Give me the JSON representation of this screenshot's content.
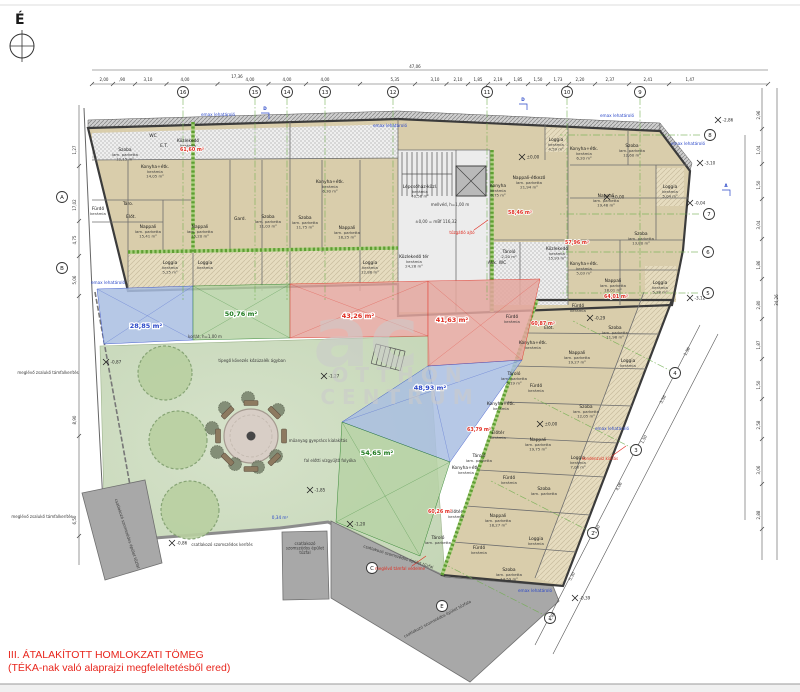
{
  "title_block": {
    "line1": "III. ÁTALAKÍTOTT HOMLOKZATI TÖMEG",
    "line2": "(TÉKA-nak való alaprajzi megfeleltetésből ered)"
  },
  "north": {
    "label": "É"
  },
  "watermark": {
    "monogram": "ac",
    "line1": "OTTHON",
    "line2": "CENTRUM"
  },
  "colors": {
    "room_fill": "#d9cdab",
    "loggia_fill": "#e3d9bd",
    "corridor_fill": "#ededed",
    "garden": "#cddcc1",
    "neighbor_gray": "#a8a8a8",
    "wall": "#3b3b3b",
    "green_wall": "#5f9e33",
    "grid_green": "#6fae4e",
    "zone_blue": "#aabfe2",
    "zone_green": "#b8d3a6",
    "zone_red": "#e4a79f",
    "text_blue": "#2b48c8",
    "text_green": "#1e7a1e",
    "text_red": "#e02c20"
  },
  "grid_bubbles": {
    "top": [
      {
        "l": "16",
        "x": 183
      },
      {
        "l": "15",
        "x": 255
      },
      {
        "l": "14",
        "x": 287
      },
      {
        "l": "13",
        "x": 325
      },
      {
        "l": "12",
        "x": 393
      },
      {
        "l": "11",
        "x": 487
      },
      {
        "l": "10",
        "x": 567
      },
      {
        "l": "9",
        "x": 640
      }
    ],
    "right": [
      {
        "l": "8",
        "x": 710,
        "y": 135
      },
      {
        "l": "7",
        "x": 709,
        "y": 214
      },
      {
        "l": "6",
        "x": 708,
        "y": 252
      },
      {
        "l": "5",
        "x": 708,
        "y": 293
      }
    ],
    "diag": [
      {
        "l": "4",
        "x": 675,
        "y": 373
      },
      {
        "l": "3",
        "x": 636,
        "y": 450
      },
      {
        "l": "2",
        "x": 593,
        "y": 533
      },
      {
        "l": "1",
        "x": 550,
        "y": 618
      }
    ],
    "letters": [
      {
        "l": "A",
        "x": 62,
        "y": 197
      },
      {
        "l": "B",
        "x": 62,
        "y": 268
      },
      {
        "l": "C",
        "x": 372,
        "y": 568
      },
      {
        "l": "E",
        "x": 442,
        "y": 606
      }
    ]
  },
  "dimensions": {
    "total_top": {
      "t": "47,06",
      "x": 415,
      "y": 68
    },
    "mid_top": {
      "t": "17,36",
      "x": 237,
      "y": 78
    },
    "top_row": [
      {
        "t": "2,00",
        "x": 104
      },
      {
        "t": ",90",
        "x": 122
      },
      {
        "t": "3,10",
        "x": 148
      },
      {
        "t": "4,00",
        "x": 185
      },
      {
        "t": "4,00",
        "x": 250
      },
      {
        "t": "4,00",
        "x": 287
      },
      {
        "t": "4,00",
        "x": 325
      },
      {
        "t": "5,35",
        "x": 395
      },
      {
        "t": "3,10",
        "x": 435
      },
      {
        "t": "2,10",
        "x": 458
      },
      {
        "t": "1,85",
        "x": 478
      },
      {
        "t": "2,19",
        "x": 498
      },
      {
        "t": "1,85",
        "x": 518
      },
      {
        "t": "1,50",
        "x": 538
      },
      {
        "t": "1,73",
        "x": 558
      },
      {
        "t": "2,20",
        "x": 580
      },
      {
        "t": "2,37",
        "x": 610
      },
      {
        "t": "2,41",
        "x": 648
      },
      {
        "t": "1,47",
        "x": 690
      }
    ],
    "left_col": [
      {
        "t": "1,27",
        "y": 150
      },
      {
        "t": "17,02",
        "y": 205
      },
      {
        "t": "4,75",
        "y": 240
      },
      {
        "t": "5,06",
        "y": 280
      },
      {
        "t": "8,90",
        "y": 420
      },
      {
        "t": "6,50",
        "y": 520
      }
    ],
    "right_col": [
      {
        "t": "2,96",
        "y": 115
      },
      {
        "t": "1,04",
        "y": 150
      },
      {
        "t": "1,50",
        "y": 185
      },
      {
        "t": "3,04",
        "y": 225
      },
      {
        "t": "1,86",
        "y": 265
      },
      {
        "t": "2,80",
        "y": 305
      },
      {
        "t": "1,87",
        "y": 345
      },
      {
        "t": "1,50",
        "y": 385
      },
      {
        "t": "2,58",
        "y": 425
      },
      {
        "t": "3,06",
        "y": 470
      },
      {
        "t": "2,88",
        "y": 515
      }
    ],
    "right_total": {
      "t": "34,26",
      "x": 778,
      "y": 300
    },
    "diag_chain": [
      {
        "t": "1,36",
        "x": 688,
        "y": 352
      },
      {
        "t": "3,56",
        "x": 664,
        "y": 400
      },
      {
        "t": "1,50",
        "x": 645,
        "y": 440
      },
      {
        "t": "4,06",
        "x": 620,
        "y": 487
      },
      {
        "t": "1,50",
        "x": 598,
        "y": 530
      },
      {
        "t": "5,30",
        "x": 573,
        "y": 577
      },
      {
        "t": "2,88",
        "x": 553,
        "y": 617
      }
    ]
  },
  "zones": [
    {
      "label": "28,85 m²",
      "c": "#aabfe2",
      "t": "#2b48c8",
      "pts": "97,289 193,286 193,340 104,344",
      "lx": 146,
      "ly": 328
    },
    {
      "label": "50,76 m²",
      "c": "#b8d3a6",
      "t": "#1e7a1e",
      "pts": "193,286 290,284 290,338 193,340",
      "lx": 241,
      "ly": 316
    },
    {
      "label": "43,26 m²",
      "c": "#e4a79f",
      "t": "#e02c20",
      "pts": "290,284 428,281 428,336 290,338",
      "lx": 358,
      "ly": 318
    },
    {
      "label": "41,63 m²",
      "c": "#e4a79f",
      "t": "#e02c20",
      "pts": "428,281 540,279 522,360 428,366",
      "lx": 452,
      "ly": 322
    },
    {
      "label": "48,93 m²",
      "c": "#aabfe2",
      "t": "#2b48c8",
      "pts": "428,366 522,360 450,462 342,422",
      "lx": 430,
      "ly": 390
    },
    {
      "label": "54,65 m²",
      "c": "#b8d3a6",
      "t": "#1e7a1e",
      "pts": "342,422 450,462 420,556 336,522",
      "lx": 377,
      "ly": 455
    }
  ],
  "rooms": [
    {
      "x": 125,
      "y": 151,
      "lines": [
        "Szoba",
        "lam. parketta",
        "12,15 m²"
      ]
    },
    {
      "x": 155,
      "y": 168,
      "lines": [
        "Konyha+étk.",
        "kerámia",
        "14,05 m²"
      ]
    },
    {
      "x": 98,
      "y": 210,
      "lines": [
        "Fürdő",
        "kerámia"
      ]
    },
    {
      "x": 128,
      "y": 205,
      "lines": [
        "Táro."
      ]
    },
    {
      "x": 131,
      "y": 218,
      "lines": [
        "Előt."
      ]
    },
    {
      "x": 148,
      "y": 228,
      "lines": [
        "Nappali",
        "lam. parketta",
        "15,41 m²"
      ]
    },
    {
      "x": 170,
      "y": 264,
      "lines": [
        "Loggia",
        "kerámia",
        "5,25 m²"
      ]
    },
    {
      "x": 200,
      "y": 228,
      "lines": [
        "Nappali",
        "lam. parketta",
        "15,20 m²"
      ]
    },
    {
      "x": 240,
      "y": 220,
      "lines": [
        "Gard."
      ]
    },
    {
      "x": 268,
      "y": 218,
      "lines": [
        "Szoba",
        "lam. parketta",
        "11,03 m²"
      ]
    },
    {
      "x": 205,
      "y": 264,
      "lines": [
        "Loggia",
        "kerámia"
      ]
    },
    {
      "x": 330,
      "y": 183,
      "lines": [
        "Konyha+étk.",
        "kerámia",
        "6,30 m²"
      ]
    },
    {
      "x": 305,
      "y": 219,
      "lines": [
        "Szoba",
        "lam. parketta",
        "11,75 m²"
      ]
    },
    {
      "x": 347,
      "y": 229,
      "lines": [
        "Nappali",
        "lam. parketta",
        "18,25 m²"
      ]
    },
    {
      "x": 370,
      "y": 264,
      "lines": [
        "Loggia",
        "kerámia",
        "12,86 m²"
      ]
    },
    {
      "x": 153,
      "y": 137,
      "lines": [
        "WC"
      ]
    },
    {
      "x": 164,
      "y": 147,
      "lines": [
        "E.T."
      ]
    },
    {
      "x": 188,
      "y": 142,
      "lines": [
        "Közlekedő",
        "kerámia"
      ]
    },
    {
      "x": 420,
      "y": 188,
      "lines": [
        "Lépcsőház-közl.",
        "kerámia",
        "40,56 m²"
      ]
    },
    {
      "x": 414,
      "y": 258,
      "lines": [
        "Közlekedő tér",
        "kerámia",
        "24,28 m²"
      ]
    },
    {
      "x": 498,
      "y": 187,
      "lines": [
        "Konyha",
        "kerámia",
        "6,75 m²"
      ]
    },
    {
      "x": 529,
      "y": 179,
      "lines": [
        "Nappali-étkező",
        "lam. parketta",
        "21,94 m²"
      ]
    },
    {
      "x": 556,
      "y": 141,
      "lines": [
        "Loggia",
        "kerámia",
        "4,59 m²"
      ]
    },
    {
      "x": 584,
      "y": 150,
      "lines": [
        "Konyha+étk.",
        "kerámia",
        "6,20 m²"
      ]
    },
    {
      "x": 632,
      "y": 147,
      "lines": [
        "Szoba",
        "lam. parketta",
        "12,60 m²"
      ]
    },
    {
      "x": 606,
      "y": 197,
      "lines": [
        "Nappali",
        "lam. parketta",
        "19,46 m²"
      ]
    },
    {
      "x": 670,
      "y": 188,
      "lines": [
        "Loggia",
        "kerámia",
        "5,04 m²"
      ]
    },
    {
      "x": 641,
      "y": 235,
      "lines": [
        "Szoba",
        "lam. parketta",
        "13,80 m²"
      ]
    },
    {
      "x": 509,
      "y": 253,
      "lines": [
        "Tároló",
        "2,20 m²"
      ]
    },
    {
      "x": 497,
      "y": 264,
      "lines": [
        "Akk. WC"
      ]
    },
    {
      "x": 557,
      "y": 250,
      "lines": [
        "Közlekedő",
        "kerámia",
        "15,93 m²"
      ]
    },
    {
      "x": 584,
      "y": 265,
      "lines": [
        "Konyha+étk.",
        "kerámia",
        "5,03 m²"
      ]
    },
    {
      "x": 613,
      "y": 282,
      "lines": [
        "Nappali",
        "lam. parketta",
        "18,01 m²"
      ]
    },
    {
      "x": 660,
      "y": 284,
      "lines": [
        "Loggia",
        "kerámia",
        "5,28 m²"
      ]
    },
    {
      "x": 578,
      "y": 307,
      "lines": [
        "Fürdő",
        "kerámia"
      ]
    },
    {
      "x": 512,
      "y": 318,
      "lines": [
        "Fürdő",
        "kerámia"
      ]
    },
    {
      "x": 549,
      "y": 329,
      "lines": [
        "Előt."
      ]
    },
    {
      "x": 615,
      "y": 329,
      "lines": [
        "Szoba",
        "lam. parketta",
        "11,98 m²"
      ]
    },
    {
      "x": 577,
      "y": 354,
      "lines": [
        "Nappali",
        "lam. parketta",
        "19,27 m²"
      ]
    },
    {
      "x": 628,
      "y": 362,
      "lines": [
        "Loggia",
        "kerámia"
      ]
    },
    {
      "x": 533,
      "y": 344,
      "lines": [
        "Konyha+étk.",
        "kerámia"
      ]
    },
    {
      "x": 514,
      "y": 375,
      "lines": [
        "Tároló",
        "lam. parketta",
        "5,19 m²"
      ]
    },
    {
      "x": 536,
      "y": 387,
      "lines": [
        "Fürdő",
        "kerámia"
      ]
    },
    {
      "x": 586,
      "y": 408,
      "lines": [
        "Szoba",
        "lam. parketta",
        "12,05 m²"
      ]
    },
    {
      "x": 501,
      "y": 405,
      "lines": [
        "Konyha+étk.",
        "kerámia"
      ]
    },
    {
      "x": 498,
      "y": 434,
      "lines": [
        "Előtér",
        "kerámia"
      ]
    },
    {
      "x": 538,
      "y": 441,
      "lines": [
        "Nappali",
        "lam. parketta",
        "19,75 m²"
      ]
    },
    {
      "x": 479,
      "y": 457,
      "lines": [
        "Tároló",
        "lam. parketta"
      ]
    },
    {
      "x": 578,
      "y": 459,
      "lines": [
        "Loggia",
        "kerámia",
        "7,08 m²"
      ]
    },
    {
      "x": 466,
      "y": 469,
      "lines": [
        "Konyha+étk.",
        "kerámia"
      ]
    },
    {
      "x": 509,
      "y": 479,
      "lines": [
        "Fürdő",
        "kerámia"
      ]
    },
    {
      "x": 544,
      "y": 490,
      "lines": [
        "Szoba",
        "lam. parketta"
      ]
    },
    {
      "x": 456,
      "y": 513,
      "lines": [
        "Előtér",
        "kerámia"
      ]
    },
    {
      "x": 498,
      "y": 517,
      "lines": [
        "Nappali",
        "lam. parketta",
        "18,27 m²"
      ]
    },
    {
      "x": 438,
      "y": 539,
      "lines": [
        "Tároló",
        "lam. parketta"
      ]
    },
    {
      "x": 479,
      "y": 549,
      "lines": [
        "Fürdő",
        "kerámia"
      ]
    },
    {
      "x": 536,
      "y": 540,
      "lines": [
        "Loggia",
        "kerámia"
      ]
    },
    {
      "x": 509,
      "y": 571,
      "lines": [
        "Szoba",
        "lam. parketta",
        "14,59 m²"
      ]
    }
  ],
  "red_areas": [
    {
      "t": "61,60 m²",
      "x": 192,
      "y": 151
    },
    {
      "t": "58,46 m²",
      "x": 520,
      "y": 214
    },
    {
      "t": "57,96 m²",
      "x": 577,
      "y": 244
    },
    {
      "t": "64,01 m²",
      "x": 616,
      "y": 298
    },
    {
      "t": "60,87 m²",
      "x": 543,
      "y": 325
    },
    {
      "t": "63,79 m²",
      "x": 479,
      "y": 431
    },
    {
      "t": "60,26 m²",
      "x": 440,
      "y": 513
    }
  ],
  "annotations": {
    "blue": [
      {
        "t": "emax lehatároló",
        "x": 218,
        "y": 116
      },
      {
        "t": "emax lehatároló",
        "x": 390,
        "y": 127
      },
      {
        "t": "emax lehatároló",
        "x": 617,
        "y": 117
      },
      {
        "t": "emax lehatároló",
        "x": 108,
        "y": 284
      },
      {
        "t": "emax lehatároló",
        "x": 688,
        "y": 145
      },
      {
        "t": "emax lehatároló",
        "x": 612,
        "y": 430
      },
      {
        "t": "emax lehatároló",
        "x": 535,
        "y": 592
      },
      {
        "t": "0,34 m²",
        "x": 280,
        "y": 519
      },
      {
        "t": "D",
        "x": 265,
        "y": 110
      },
      {
        "t": "D",
        "x": 523,
        "y": 101
      },
      {
        "t": "A",
        "x": 726,
        "y": 187
      }
    ],
    "gray": [
      {
        "t": "±0,00 = mBf 116,32",
        "x": 436,
        "y": 223
      },
      {
        "t": "mellvéd, h=1,00 m",
        "x": 450,
        "y": 206
      },
      {
        "t": "korlát, h=1,00 m",
        "x": 205,
        "y": 338
      },
      {
        "t": "tipegő kövezés kőzúzalék ágyban",
        "x": 252,
        "y": 362
      },
      {
        "t": "műanyag gyeprács kialakítás",
        "x": 318,
        "y": 442
      },
      {
        "t": "fal előtti vízgyűjtő folyóka",
        "x": 330,
        "y": 462
      },
      {
        "t": "meglévő zsalukő támfalkerítés",
        "x": 48,
        "y": 374
      },
      {
        "t": "meglévő zsalukő támfalkerítés",
        "x": 42,
        "y": 518
      },
      {
        "t": "csatlakozó szomszédos kerítés",
        "x": 222,
        "y": 546
      }
    ],
    "red": [
      {
        "t": "tűzgátló ajtó",
        "x": 462,
        "y": 234
      },
      {
        "t": "kondenzvíz kiállás",
        "x": 600,
        "y": 460
      },
      {
        "t": "meglévő támfal védelme",
        "x": 400,
        "y": 570
      }
    ]
  },
  "neighbor_labels": [
    {
      "lines": [
        "csatlakozó szomszédos épület tűzfal"
      ],
      "x": 126,
      "y": 534,
      "r": 72
    },
    {
      "lines": [
        "csatlakozó",
        "szomszédos épület",
        "tűzfal"
      ],
      "x": 305,
      "y": 545,
      "r": 0
    },
    {
      "lines": [
        "csatlakozó szomszédos épület tűzfal"
      ],
      "x": 398,
      "y": 558,
      "r": 17
    },
    {
      "lines": [
        "csatlakozó szomszédos épület tűzfala"
      ],
      "x": 438,
      "y": 620,
      "r": -28
    }
  ],
  "levels": [
    {
      "t": "±0,00",
      "x": 522,
      "y": 157
    },
    {
      "t": "±0,00",
      "x": 607,
      "y": 197
    },
    {
      "t": "±0,00",
      "x": 540,
      "y": 424
    },
    {
      "t": "-2,86",
      "x": 718,
      "y": 120
    },
    {
      "t": "-3,10",
      "x": 700,
      "y": 163
    },
    {
      "t": "-0,04",
      "x": 690,
      "y": 203
    },
    {
      "t": "-3,12",
      "x": 690,
      "y": 298
    },
    {
      "t": "-0,29",
      "x": 590,
      "y": 318
    },
    {
      "t": "-1,27",
      "x": 324,
      "y": 376
    },
    {
      "t": "-1,85",
      "x": 310,
      "y": 490
    },
    {
      "t": "-0,87",
      "x": 106,
      "y": 362
    },
    {
      "t": "-0,86",
      "x": 172,
      "y": 543
    },
    {
      "t": "-1,20",
      "x": 350,
      "y": 524
    },
    {
      "t": "-0,39",
      "x": 575,
      "y": 598
    }
  ],
  "patio": {
    "cx": 251,
    "cy": 436,
    "r": 27,
    "bench_radius": 33,
    "bench_count": 8
  },
  "trees": [
    {
      "x": 165,
      "y": 373,
      "r": 27
    },
    {
      "x": 178,
      "y": 440,
      "r": 29
    },
    {
      "x": 190,
      "y": 510,
      "r": 29
    }
  ],
  "bushes": [
    {
      "x": 248,
      "y": 398
    },
    {
      "x": 225,
      "y": 408
    },
    {
      "x": 212,
      "y": 428
    },
    {
      "x": 217,
      "y": 452
    },
    {
      "x": 235,
      "y": 464
    },
    {
      "x": 258,
      "y": 467
    },
    {
      "x": 276,
      "y": 456
    },
    {
      "x": 278,
      "y": 410
    }
  ]
}
